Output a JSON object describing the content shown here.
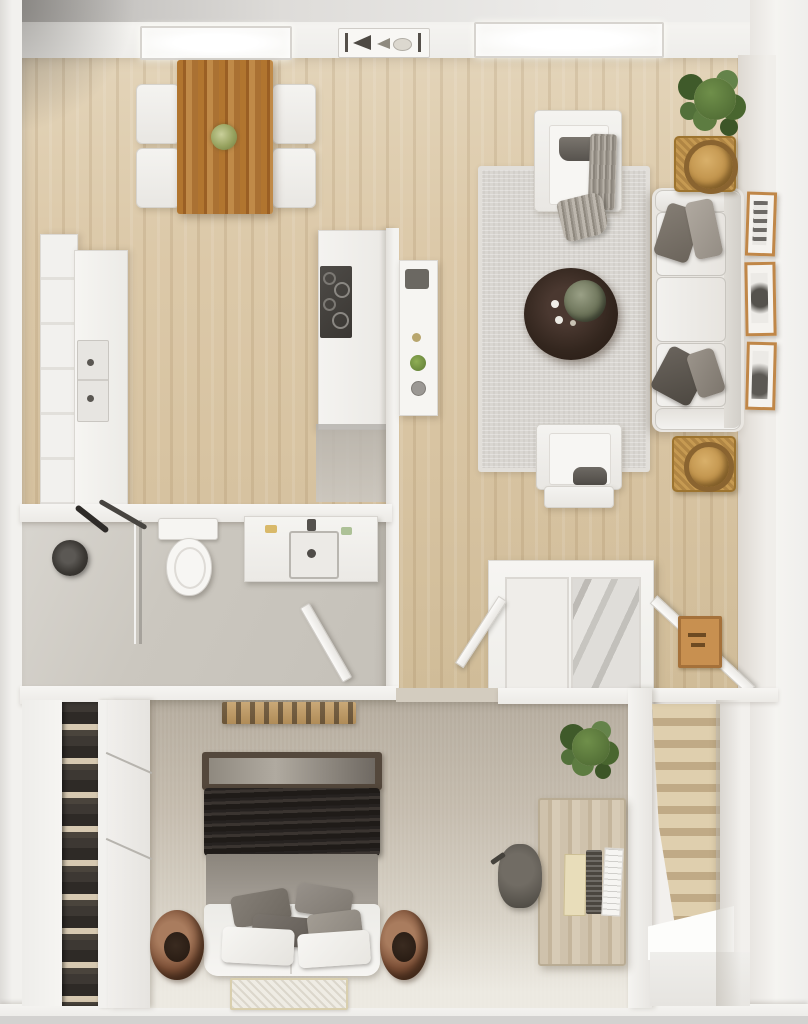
{
  "scene": {
    "type": "3d-floor-plan-top-view",
    "rooms": [
      {
        "name": "dining-area",
        "contents": [
          "wood-dining-table",
          "green-centerpiece",
          "four-white-chairs",
          "ceiling-light-panel"
        ]
      },
      {
        "name": "kitchen",
        "contents": [
          "tall-cabinet-run",
          "counter-with-double-sink",
          "cooktop-counter",
          "wall-shelf-with-jars"
        ]
      },
      {
        "name": "living-room",
        "contents": [
          "area-rug",
          "two-armchairs",
          "grey-throw-blanket",
          "round-espresso-coffee-table",
          "three-seat-sofa",
          "two-wicker-side-tables",
          "corner-plant",
          "three-wall-frames"
        ]
      },
      {
        "name": "bathroom",
        "contents": [
          "walk-in-shower",
          "shower-head",
          "toilet",
          "vanity-with-sink",
          "open-door"
        ]
      },
      {
        "name": "entry-closet",
        "contents": [
          "double-panel-wardrobe",
          "mirror-door",
          "two-open-doors",
          "tan-doormat"
        ]
      },
      {
        "name": "bedroom",
        "contents": [
          "double-bed",
          "dark-duvet",
          "grey-folded-blanket",
          "pillow-cluster",
          "two-round-baskets",
          "foot-rug",
          "wall-shelf",
          "shoe-closet",
          "sliding-door"
        ]
      },
      {
        "name": "office-nook",
        "contents": [
          "wood-desk",
          "desk-chair",
          "laptop",
          "notepad",
          "paper-stack",
          "potted-plant"
        ]
      },
      {
        "name": "staircase",
        "contents": [
          "wood-steps",
          "white-landing"
        ]
      }
    ],
    "ceiling_fixtures": [
      "light-panel-left",
      "air-vent-badge",
      "light-panel-right"
    ]
  },
  "palette": {
    "wall": "#f2f0ed",
    "wall-shadow": "#d8d5d0",
    "wood": "#d9c6a6",
    "wood-grain": "#c4ad87",
    "rug": "#d9d6d1",
    "carpet": "#c2b9ab",
    "carpet-light": "#ece9e2",
    "bath-floor": "#c9c5bd",
    "table-wood": "#b07a3c",
    "espresso": "#33261e",
    "wicker": "#c69a52",
    "frame-wood": "#c08748",
    "plant": "#56743a",
    "plant-dark": "#3d5628",
    "duvet": "#2b2623",
    "blanket": "#928c83",
    "basket": "#7c4f36",
    "stair-tread": "#dfcfae",
    "stair-riser": "#c0aa86",
    "desk-wood": "#cdc0a9",
    "fixture-dark": "#3a3733",
    "upholstery": "#efedea",
    "cushion-grey": "#6e6a64"
  }
}
